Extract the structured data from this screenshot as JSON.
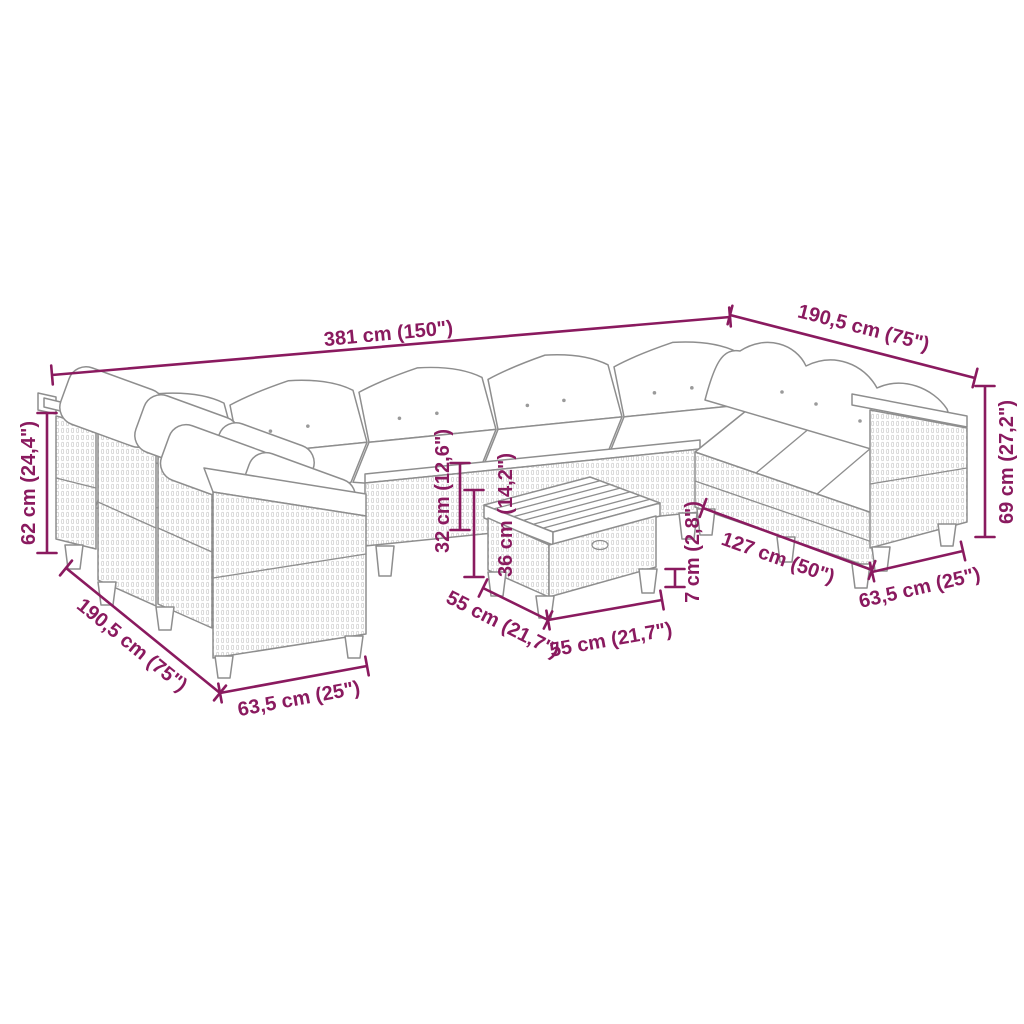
{
  "figure": {
    "kind": "product dimension diagram",
    "subject": "rattan garden lounge set with corner sofa modules and ottoman table"
  },
  "colors": {
    "dimension": "#8A1A5F",
    "furniture_line": "#8E8E8E",
    "rattan_texture": "#C2C2C2",
    "background": "#FFFFFF",
    "cushion": "#FFFFFF"
  },
  "dimensions": [
    {
      "id": "overall-width",
      "label": "381 cm (150\")",
      "x1": 52,
      "y1": 375,
      "x2": 730,
      "y2": 317,
      "lx": 389,
      "ly": 340,
      "rot": -5.4
    },
    {
      "id": "right-depth",
      "label": "190,5 cm (75\")",
      "x1": 730,
      "y1": 315,
      "x2": 975,
      "y2": 378,
      "lx": 862,
      "ly": 334,
      "rot": 14.6
    },
    {
      "id": "right-height",
      "label": "69 cm (27,2\")",
      "x1": 985,
      "y1": 386,
      "x2": 985,
      "y2": 537,
      "lx": 1013,
      "ly": 462,
      "rot": -90
    },
    {
      "id": "right-module-width",
      "label": "63,5 cm (25\")",
      "x1": 872,
      "y1": 572,
      "x2": 963,
      "y2": 551,
      "lx": 921,
      "ly": 594,
      "rot": -13
    },
    {
      "id": "inner-width",
      "label": "127 cm (50\")",
      "x1": 703,
      "y1": 508,
      "x2": 872,
      "y2": 570,
      "lx": 776,
      "ly": 564,
      "rot": 19.5
    },
    {
      "id": "table-leg-height",
      "label": "7 cm (2,8\")",
      "x1": 675,
      "y1": 569,
      "x2": 675,
      "y2": 587,
      "lx": 699,
      "ly": 552,
      "rot": -90
    },
    {
      "id": "table-height",
      "label": "36 cm (14,2\")",
      "x1": 474,
      "y1": 490,
      "x2": 474,
      "y2": 577,
      "lx": 512,
      "ly": 515,
      "rot": -90
    },
    {
      "id": "seat-height",
      "label": "32 cm (12,6\")",
      "x1": 460,
      "y1": 463,
      "x2": 460,
      "y2": 530,
      "lx": 449,
      "ly": 491,
      "rot": -90
    },
    {
      "id": "left-height",
      "label": "62 cm (24,4\")",
      "x1": 47,
      "y1": 413,
      "x2": 47,
      "y2": 553,
      "lx": 35,
      "ly": 483,
      "rot": -90
    },
    {
      "id": "left-depth",
      "label": "190,5 cm (75\")",
      "x1": 66,
      "y1": 568,
      "x2": 220,
      "y2": 693,
      "lx": 128,
      "ly": 650,
      "rot": 39
    },
    {
      "id": "left-module-width",
      "label": "63,5 cm (25\")",
      "x1": 220,
      "y1": 693,
      "x2": 367,
      "y2": 666,
      "lx": 300,
      "ly": 705,
      "rot": -10.4
    },
    {
      "id": "table-depth",
      "label": "55 cm (21,7\")",
      "x1": 483,
      "y1": 588,
      "x2": 548,
      "y2": 620,
      "lx": 500,
      "ly": 630,
      "rot": 27
    },
    {
      "id": "table-width",
      "label": "55 cm (21,7\")",
      "x1": 548,
      "y1": 620,
      "x2": 662,
      "y2": 600,
      "lx": 612,
      "ly": 646,
      "rot": -10
    }
  ]
}
